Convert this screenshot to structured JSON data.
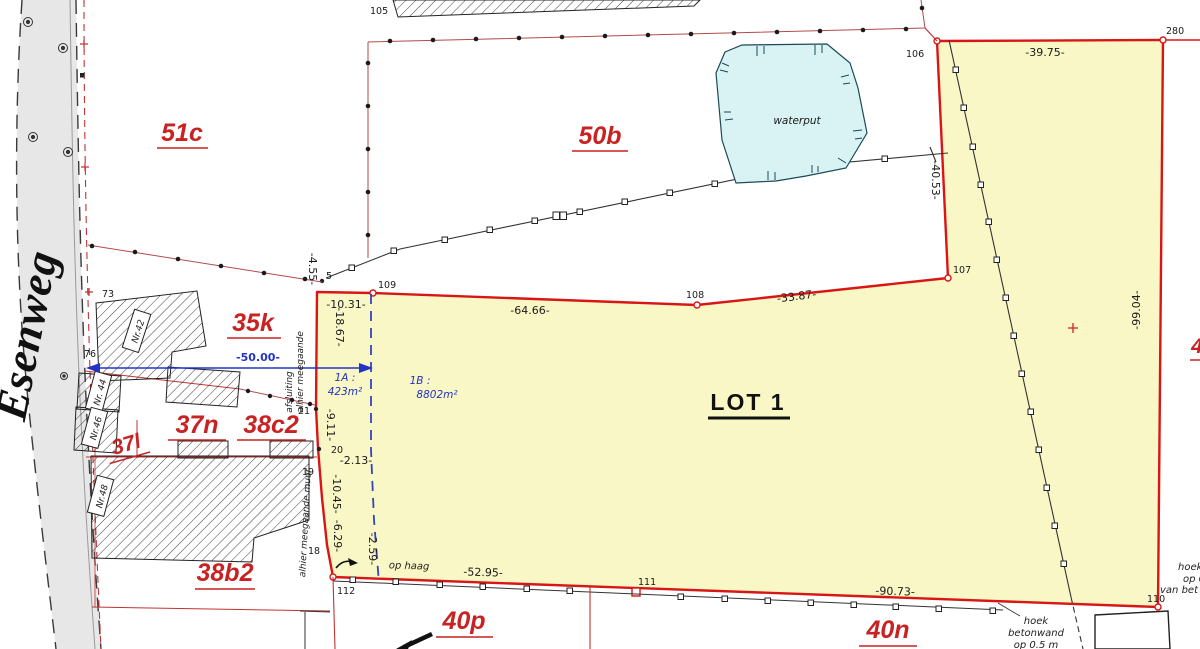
{
  "road": {
    "name": "Esenweg"
  },
  "parcels": {
    "p51c": "51c",
    "p50b": "50b",
    "p35k": "35k",
    "p37n": "37n",
    "p38c2": "38c2",
    "p37l": "37l",
    "p38b2": "38b2",
    "p40p": "40p",
    "p40n": "40n",
    "partial_right": "4"
  },
  "lot": {
    "title": "LOT 1"
  },
  "subparcels": {
    "a_name": "1A :",
    "a_area": "423m²",
    "b_name": "1B :",
    "b_area": "8802m²"
  },
  "water": {
    "label": "waterput"
  },
  "points": {
    "p5": "5",
    "p18": "18",
    "p19": "19",
    "p20": "20",
    "p21": "21",
    "p73": "73",
    "p76": "76",
    "p105": "105",
    "p106": "106",
    "p107": "107",
    "p108": "108",
    "p109": "109",
    "p110": "110",
    "p111": "111",
    "p112": "112",
    "p280": "280"
  },
  "measurements": {
    "m39_75": "-39.75-",
    "m40_53": "-40.53-",
    "m99_04": "-99.04-",
    "m10_31": "-10.31-",
    "m64_66": "-64.66-",
    "m33_87": "-33.87-",
    "m50_00": "-50.00-",
    "m4_55": "-4.55-",
    "m18_67": "-18.67-",
    "m9_11": "-9.11-",
    "m2_13": "-2.13-",
    "m10_45": "-10.45-",
    "m6_29": "-6.29-",
    "m2_59": "-2.59-",
    "m52_95": "-52.95-",
    "m90_73": "-90.73-"
  },
  "annotations": {
    "fence_line1": "alhier meegaande",
    "fence_line2": "afsluiting",
    "wall_line": "alhier meegaande muur",
    "hedge": "op haag",
    "corner_note_l1": "hoek",
    "corner_note_l2": "betonwand",
    "corner_note_l3": "op 0.5 m",
    "edge_note_l1": "hoek",
    "edge_note_l2": "op 0,",
    "edge_note_l3": "van bet"
  },
  "houses": {
    "n42": "Nr.42",
    "n44": "Nr. 44",
    "n46": "Nr.46",
    "n48": "Nr.48"
  },
  "colors": {
    "lot_fill": "#f9f7c5",
    "lot_border": "#d81616",
    "water_fill": "#d9f2f4",
    "road_fill": "#e7e7e7",
    "red_label": "#c92222",
    "blue": "#2333c4"
  }
}
